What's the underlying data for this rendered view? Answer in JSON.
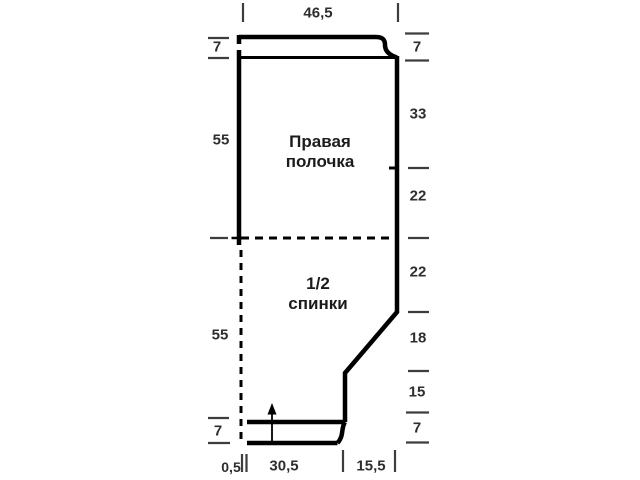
{
  "diagram": {
    "type": "sewing-pattern-schematic",
    "line_color": "#000000",
    "measure_color": "#3d3d3d",
    "labels": {
      "piece1_line1": "Правая",
      "piece1_line2": "полочка",
      "piece2_line1": "1/2",
      "piece2_line2": "спинки"
    },
    "measurements": {
      "top_width": "46,5",
      "left": [
        "7",
        "55",
        "55",
        "7"
      ],
      "right": [
        "7",
        "33",
        "22",
        "22",
        "18",
        "15",
        "7"
      ],
      "bottom": [
        "0,5",
        "30,5",
        "15,5"
      ]
    }
  }
}
